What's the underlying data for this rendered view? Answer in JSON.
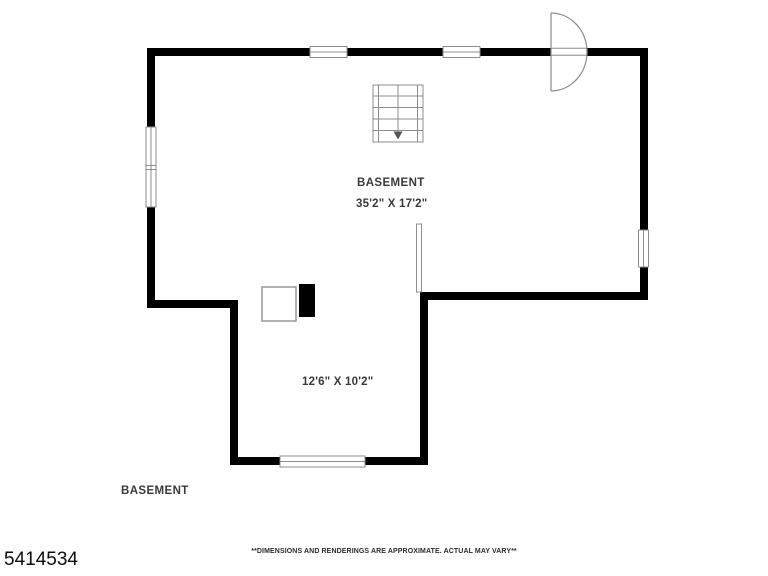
{
  "plan": {
    "rooms": {
      "main": {
        "name": "BASEMENT",
        "dims": "35'2\" X 17'2\""
      },
      "lower": {
        "dims": "12'6\" X 10'2\""
      }
    },
    "floor_label": "BASEMENT",
    "listing_id": "5414534",
    "disclaimer": "**DIMENSIONS AND RENDERINGS ARE APPROXIMATE. ACTUAL MAY VARY**",
    "symbols": {
      "stairs": "staircase with down arrow",
      "door": "exterior door swing at top-right wall",
      "windows": "five window openings (two top, one left double, one right, one bottom)",
      "utility_white": "utility box",
      "utility_black": "chimney/column"
    },
    "colors": {
      "wall": "#000000",
      "outline": "#8c8c8c",
      "text": "#3a3a3a",
      "background": "#ffffff"
    }
  }
}
